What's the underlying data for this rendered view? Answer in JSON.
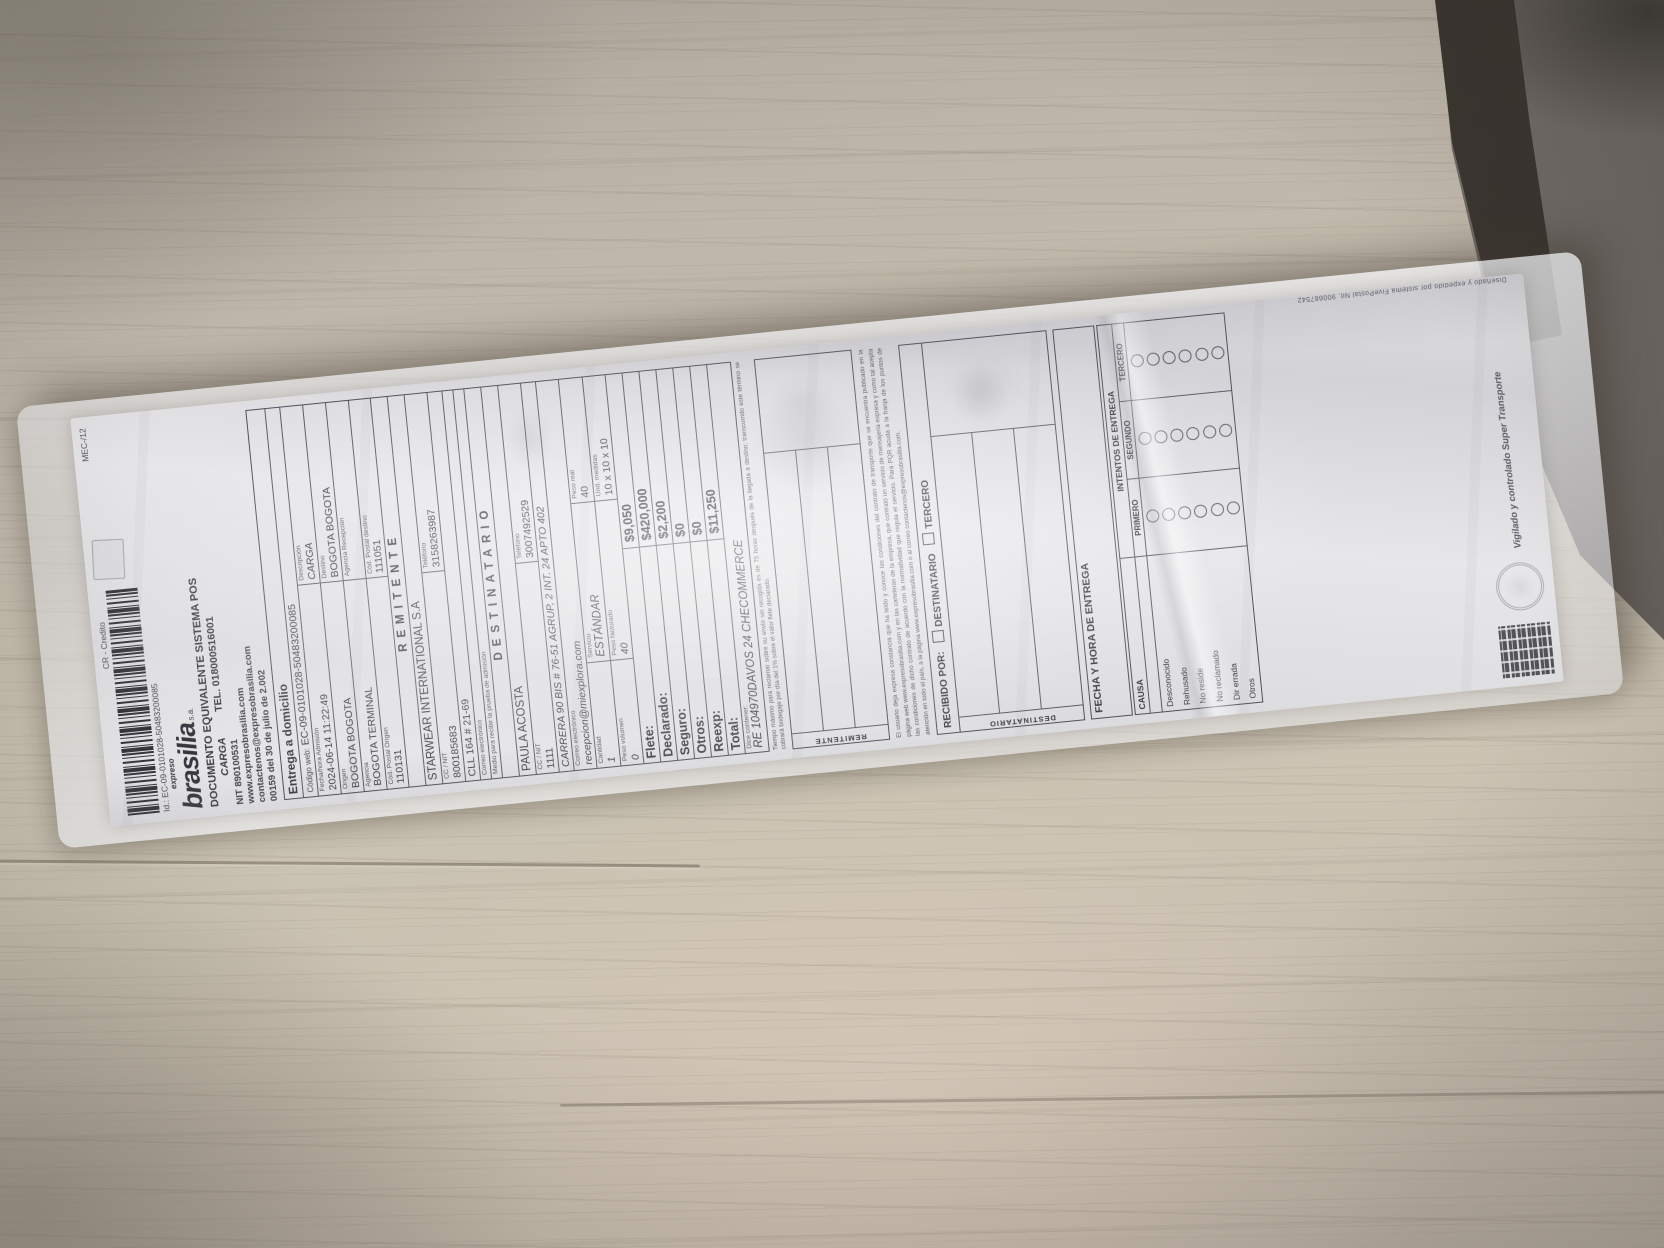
{
  "receipt": {
    "meta": {
      "payment": "CR - Credito",
      "mec": "MEC-/12",
      "id_line": "Id.: EC-09-0101028-50483200085"
    },
    "brand": {
      "pre": "expreso",
      "name": "brasilia",
      "sa": "s.a.",
      "doc_line": "DOCUMENTO EQUIVALENTE SISTEMA POS",
      "carga": "CARGA",
      "tel": "TEL. 018000516001",
      "lines": [
        "NIT 890100531",
        "www.expresobrasilia.com",
        "contactenos@expresobrasilia.com",
        "00159 del 30 de julio de 2.002"
      ]
    },
    "table": {
      "service_type": "Entrega a domicilio",
      "codigo_web": {
        "label": "Código web:",
        "value": "EC-09-0101028-50483200085"
      },
      "rows2": [
        [
          {
            "label": "Fecha/hora Admisión",
            "value": "2024-06-14 11:22:49"
          },
          {
            "label": "Descripción",
            "value": "CARGA"
          }
        ],
        [
          {
            "label": "Origen",
            "value": "BOGOTA BOGOTA"
          },
          {
            "label": "Destino",
            "value": "BOGOTA BOGOTA"
          }
        ],
        [
          {
            "label": "Agencia",
            "value": "BOGOTA TERMINAL"
          },
          {
            "label": "Agencia Recepción",
            "value": ""
          }
        ],
        [
          {
            "label": "Cód. Postal Origen",
            "value": "110131"
          },
          {
            "label": "Cód. Postal destino",
            "value": "111051"
          }
        ]
      ]
    },
    "remitente": {
      "header": "REMITENTE",
      "name": "STARWEAR INTERNATIONAL S.A",
      "cc": {
        "label": "CC / NIT",
        "value": "800185683"
      },
      "tel": {
        "label": "Teléfono",
        "value": "3158263987"
      },
      "address": "CLL 164 # 21-69",
      "email_label": "Correo electrónico",
      "email": "",
      "medio_label": "Medio para recibir la prueba de admisión"
    },
    "destinatario": {
      "header": "DESTINATARIO",
      "name": "PAULA ACOSTA",
      "cc": {
        "label": "CC / NIT",
        "value": "1111"
      },
      "tel": {
        "label": "Teléfono",
        "value": "3007492529"
      },
      "address": "CARRERA 90 BIS # 76-51 AGRUP, 2 INT. 24 APTO 402",
      "email_label": "Correo electrónico",
      "email": "recepcion@miexplora.com"
    },
    "package": {
      "row1": [
        {
          "label": "Cantidad",
          "value": "1"
        },
        {
          "label": "Servicio",
          "value": "ESTÁNDAR"
        },
        {
          "label": "Peso real",
          "value": "40"
        }
      ],
      "row2": [
        {
          "label": "Peso volumen",
          "value": "0"
        },
        {
          "label": "Peso facturado",
          "value": "40"
        },
        {
          "label": "Und. medidas",
          "value": "10 x 10 x 10"
        }
      ]
    },
    "charges": [
      {
        "label": "Flete:",
        "value": "$9,050"
      },
      {
        "label": "Declarado:",
        "value": "$420,000"
      },
      {
        "label": "Seguro:",
        "value": "$2,200"
      },
      {
        "label": "Otros:",
        "value": "$0"
      },
      {
        "label": "Reexp:",
        "value": "$0"
      },
      {
        "label": "Total:",
        "value": "$11,250"
      }
    ],
    "contents": {
      "label": "Dice contener:",
      "value": "RE 104970DAVOS 24 CHECOMMERCE"
    },
    "fine_print_claim": "Tiempo máximo para reclamar sobre su envío sin recogida es de 75 horas después de la llegada a destino; transcurrido este término se cobrará bodegaje por día del 1% sobre el valor flete declarado.",
    "signatures": {
      "remitente_label": "REMITENTE",
      "destinatario_label": "DESTINATARIO"
    },
    "legal": "El usuario deja expresa constancia que ha leído y conoce las condiciones del contrato de transporte que se encuentra publicado en la página web www.expresobrasilia.com y en las carteleras de la empresa, que contrató un servicio de mensajería expresa y como tal acepta las condiciones de dicho contrato de acuerdo con la normatividad que regula el servicio. Para PQR acuda a la franja de los puntos de atención en todo el país, a la página www.expresobrasilia.com o al correo contactenos@expresobrasilia.com.",
    "recibido": {
      "label": "RECIBIDO POR:",
      "opt1": "DESTINATARIO",
      "opt2": "TERCERO"
    },
    "delivery": {
      "fecha_label": "FECHA Y HORA DE ENTREGA",
      "causa_label": "CAUSA",
      "intentos_label": "INTENTOS DE ENTREGA",
      "cols": [
        "PRIMERO",
        "SEGUNDO",
        "TERCERO"
      ],
      "causes": [
        "Desconocido",
        "Rehusado",
        "No reside",
        "No reclamado",
        "Dir errada",
        "Otros"
      ]
    },
    "footer": {
      "vigilado": "Vigilado y controlado Super Transporte",
      "system": "Diseñado y expedido por sistema FivePostal Nit. 900687542"
    }
  }
}
